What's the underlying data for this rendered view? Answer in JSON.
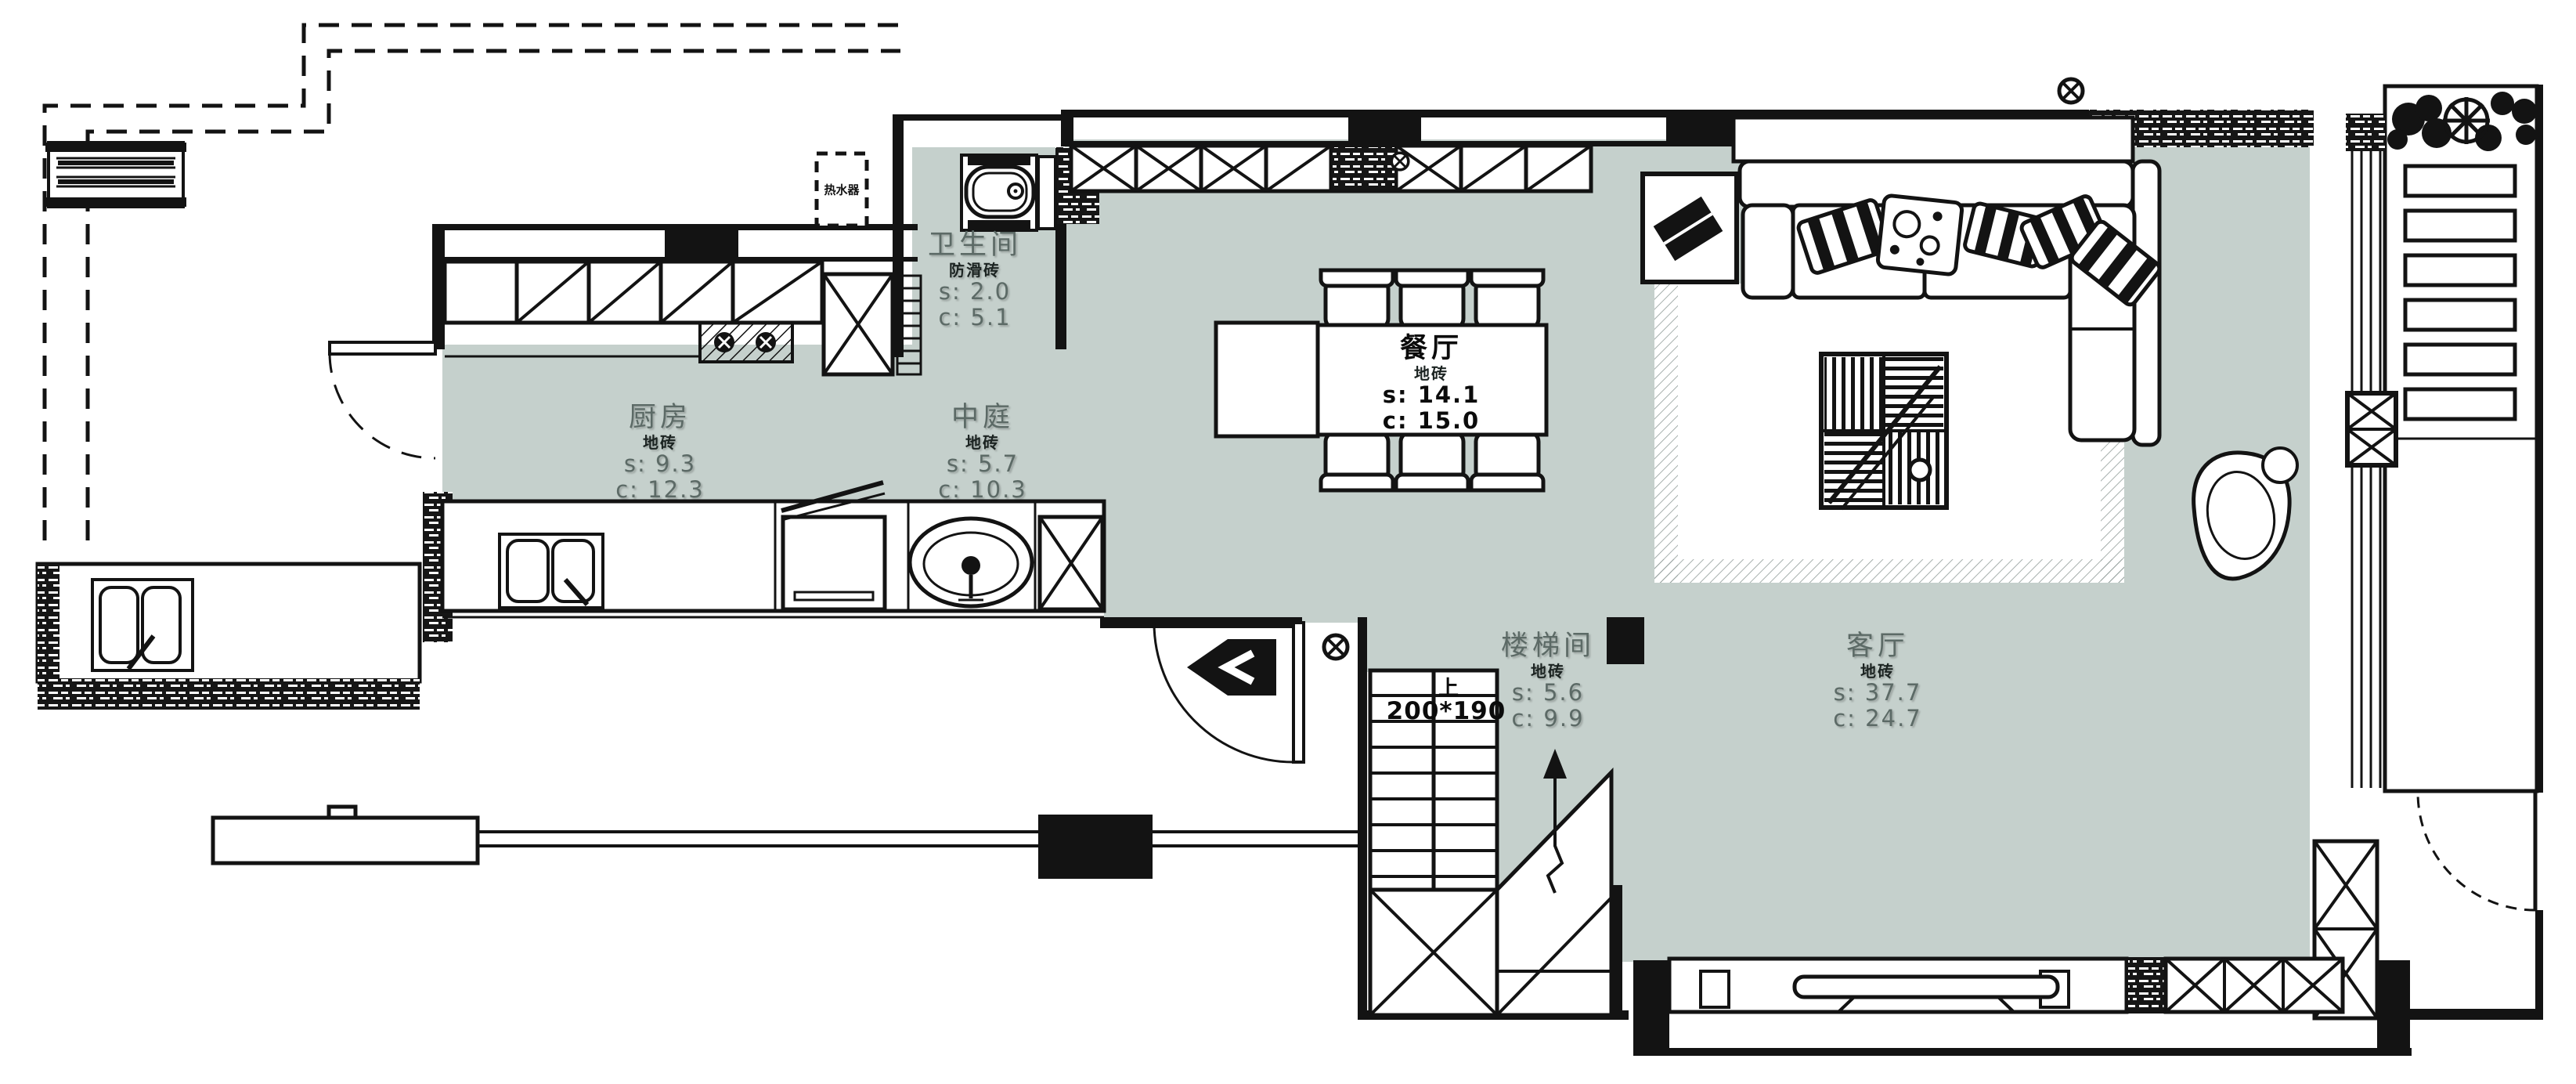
{
  "drawing": {
    "type": "floor-plan",
    "floor_fill": "#c5d0cc",
    "line_color": "#131313"
  },
  "rooms": [
    {
      "key": "bathroom",
      "name": "卫生间",
      "material": "防滑砖",
      "area": "s: 2.0",
      "circumference": "c: 5.1"
    },
    {
      "key": "kitchen",
      "name": "厨房",
      "material": "地砖",
      "area": "s: 9.3",
      "circumference": "c: 12.3"
    },
    {
      "key": "atrium",
      "name": "中庭",
      "material": "地砖",
      "area": "s: 5.7",
      "circumference": "c: 10.3"
    },
    {
      "key": "dining",
      "name": "餐厅",
      "material": "地砖",
      "area": "s: 14.1",
      "circumference": "c: 15.0"
    },
    {
      "key": "stairwell",
      "name": "楼梯间",
      "material": "地砖",
      "area": "s: 5.6",
      "circumference": "c: 9.9"
    },
    {
      "key": "living",
      "name": "客厅",
      "material": "地砖",
      "area": "s: 37.7",
      "circumference": "c: 24.7"
    }
  ],
  "stairs": {
    "direction_label": "上",
    "tread_dimension": "200*190"
  },
  "appliance_box": {
    "label": "热水器"
  },
  "symbols": {
    "crossed_circle": "⊗",
    "up_arrow": "↑"
  }
}
